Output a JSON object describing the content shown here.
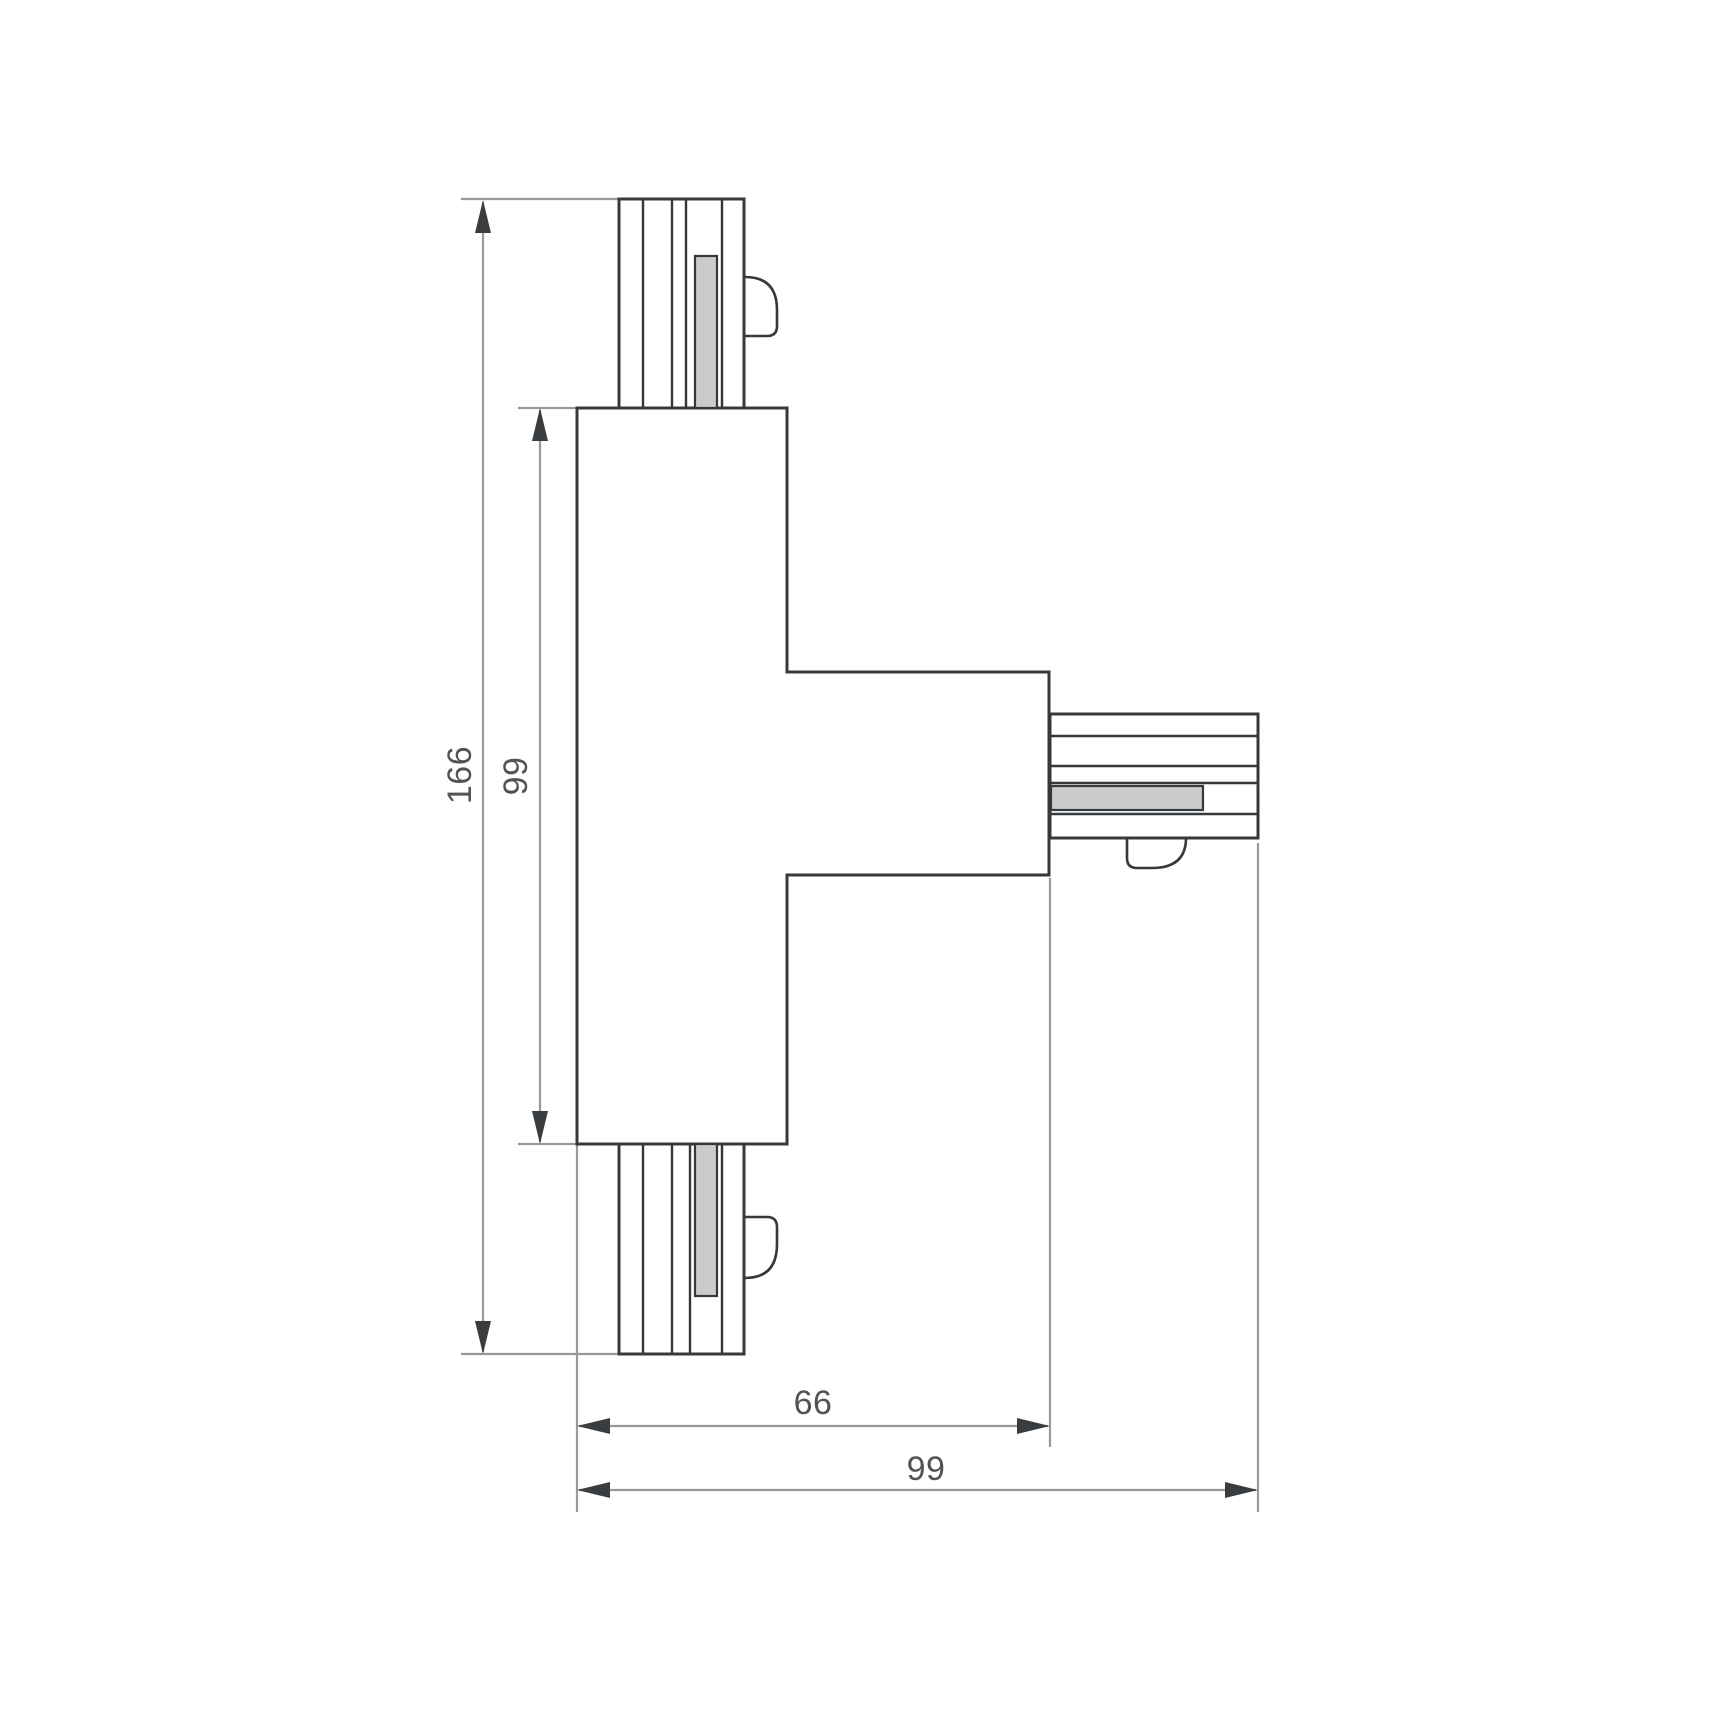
{
  "drawing": {
    "labels": {
      "overall_height": "166",
      "body_height": "99",
      "arm_length": "66",
      "overall_width": "99"
    },
    "colors": {
      "background": "#ffffff",
      "outline": "#35393c",
      "dimension_line": "#97999c",
      "dimension_text": "#515457",
      "arrowhead": "#3a3d40",
      "conductor_strip_fill": "#c9cbcd"
    },
    "icons": {
      "arrowhead": "filled-triangle"
    }
  }
}
